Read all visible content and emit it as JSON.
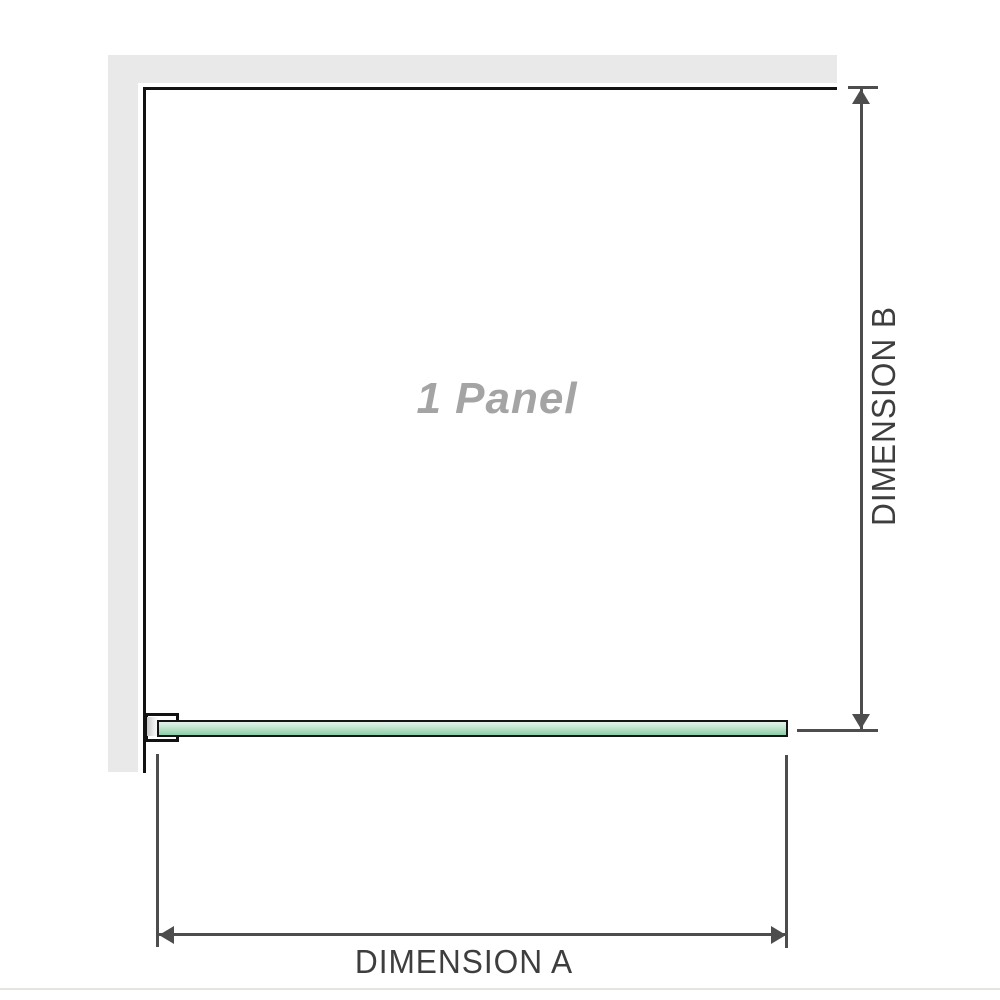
{
  "diagram": {
    "title": "1 Panel",
    "dimension_a": {
      "label": "DIMENSION A"
    },
    "dimension_b": {
      "label": "DIMENSION B"
    },
    "colors": {
      "wall_gray": "#e9e9e9",
      "panel_outline": "#121212",
      "dimension_line": "#4d4d4d",
      "dimension_text": "#3e3e3e",
      "panel_text": "#a4a4a4",
      "glass_green": "#a6dabb",
      "glass_border": "#141414",
      "footer_rule": "#e4e4e1"
    }
  }
}
